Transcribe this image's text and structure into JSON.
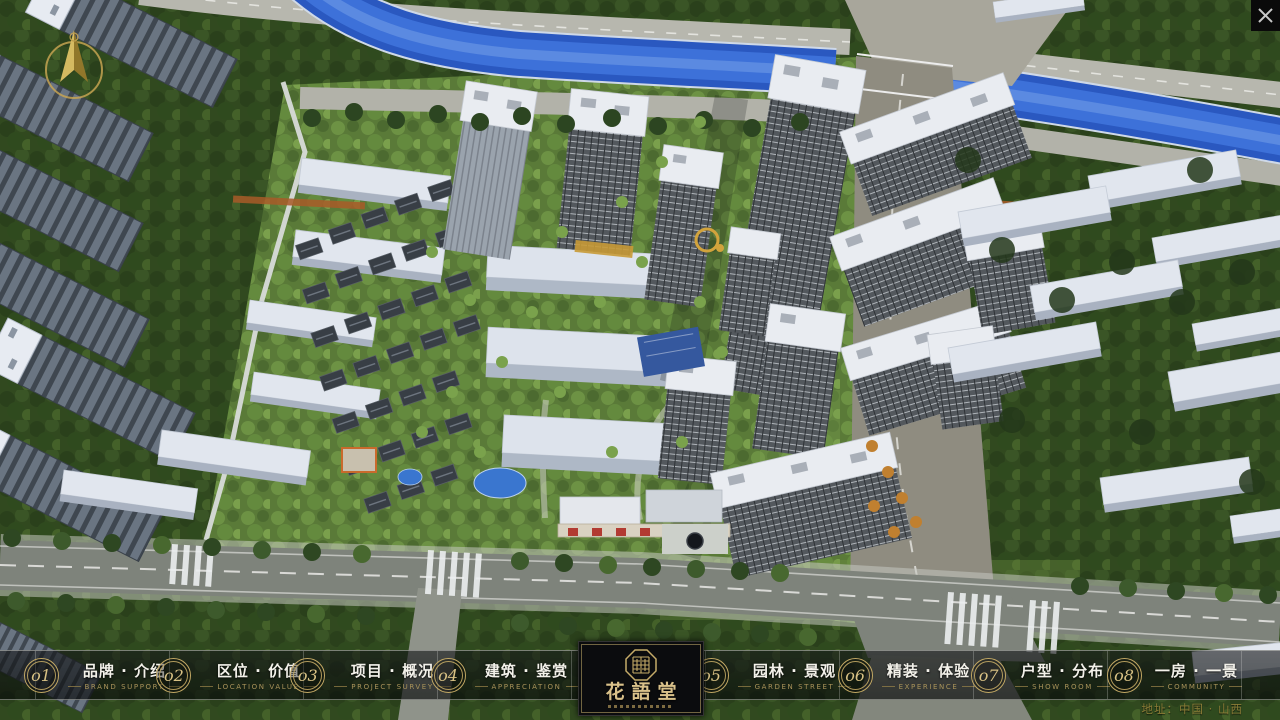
{
  "brand": {
    "name_zh": "花語堂"
  },
  "nav": {
    "items": [
      {
        "num": "o1",
        "zh": "品牌 · 介绍",
        "en": "BRAND SUPPORT"
      },
      {
        "num": "o2",
        "zh": "区位 · 价值",
        "en": "LOCATION VALUE"
      },
      {
        "num": "o3",
        "zh": "项目 · 概况",
        "en": "PROJECT SURVEY"
      },
      {
        "num": "o4",
        "zh": "建筑 · 鉴赏",
        "en": "APPRECIATION"
      },
      {
        "num": "o5",
        "zh": "园林 · 景观",
        "en": "GARDEN STREET"
      },
      {
        "num": "o6",
        "zh": "精装 · 体验",
        "en": "EXPERIENCE"
      },
      {
        "num": "o7",
        "zh": "户型 · 分布",
        "en": "SHOW ROOM"
      },
      {
        "num": "o8",
        "zh": "一房 · 一景",
        "en": "COMMUNITY"
      }
    ]
  },
  "footer": {
    "address": "地址：中国 · 山西"
  },
  "colors": {
    "accent_gold": "#c8ae6b",
    "bar_background": "rgba(10,12,14,0.62)",
    "label_text": "#f3f1ea",
    "caption_text": "#a9935a",
    "river_blue": "#3a6fd6"
  }
}
